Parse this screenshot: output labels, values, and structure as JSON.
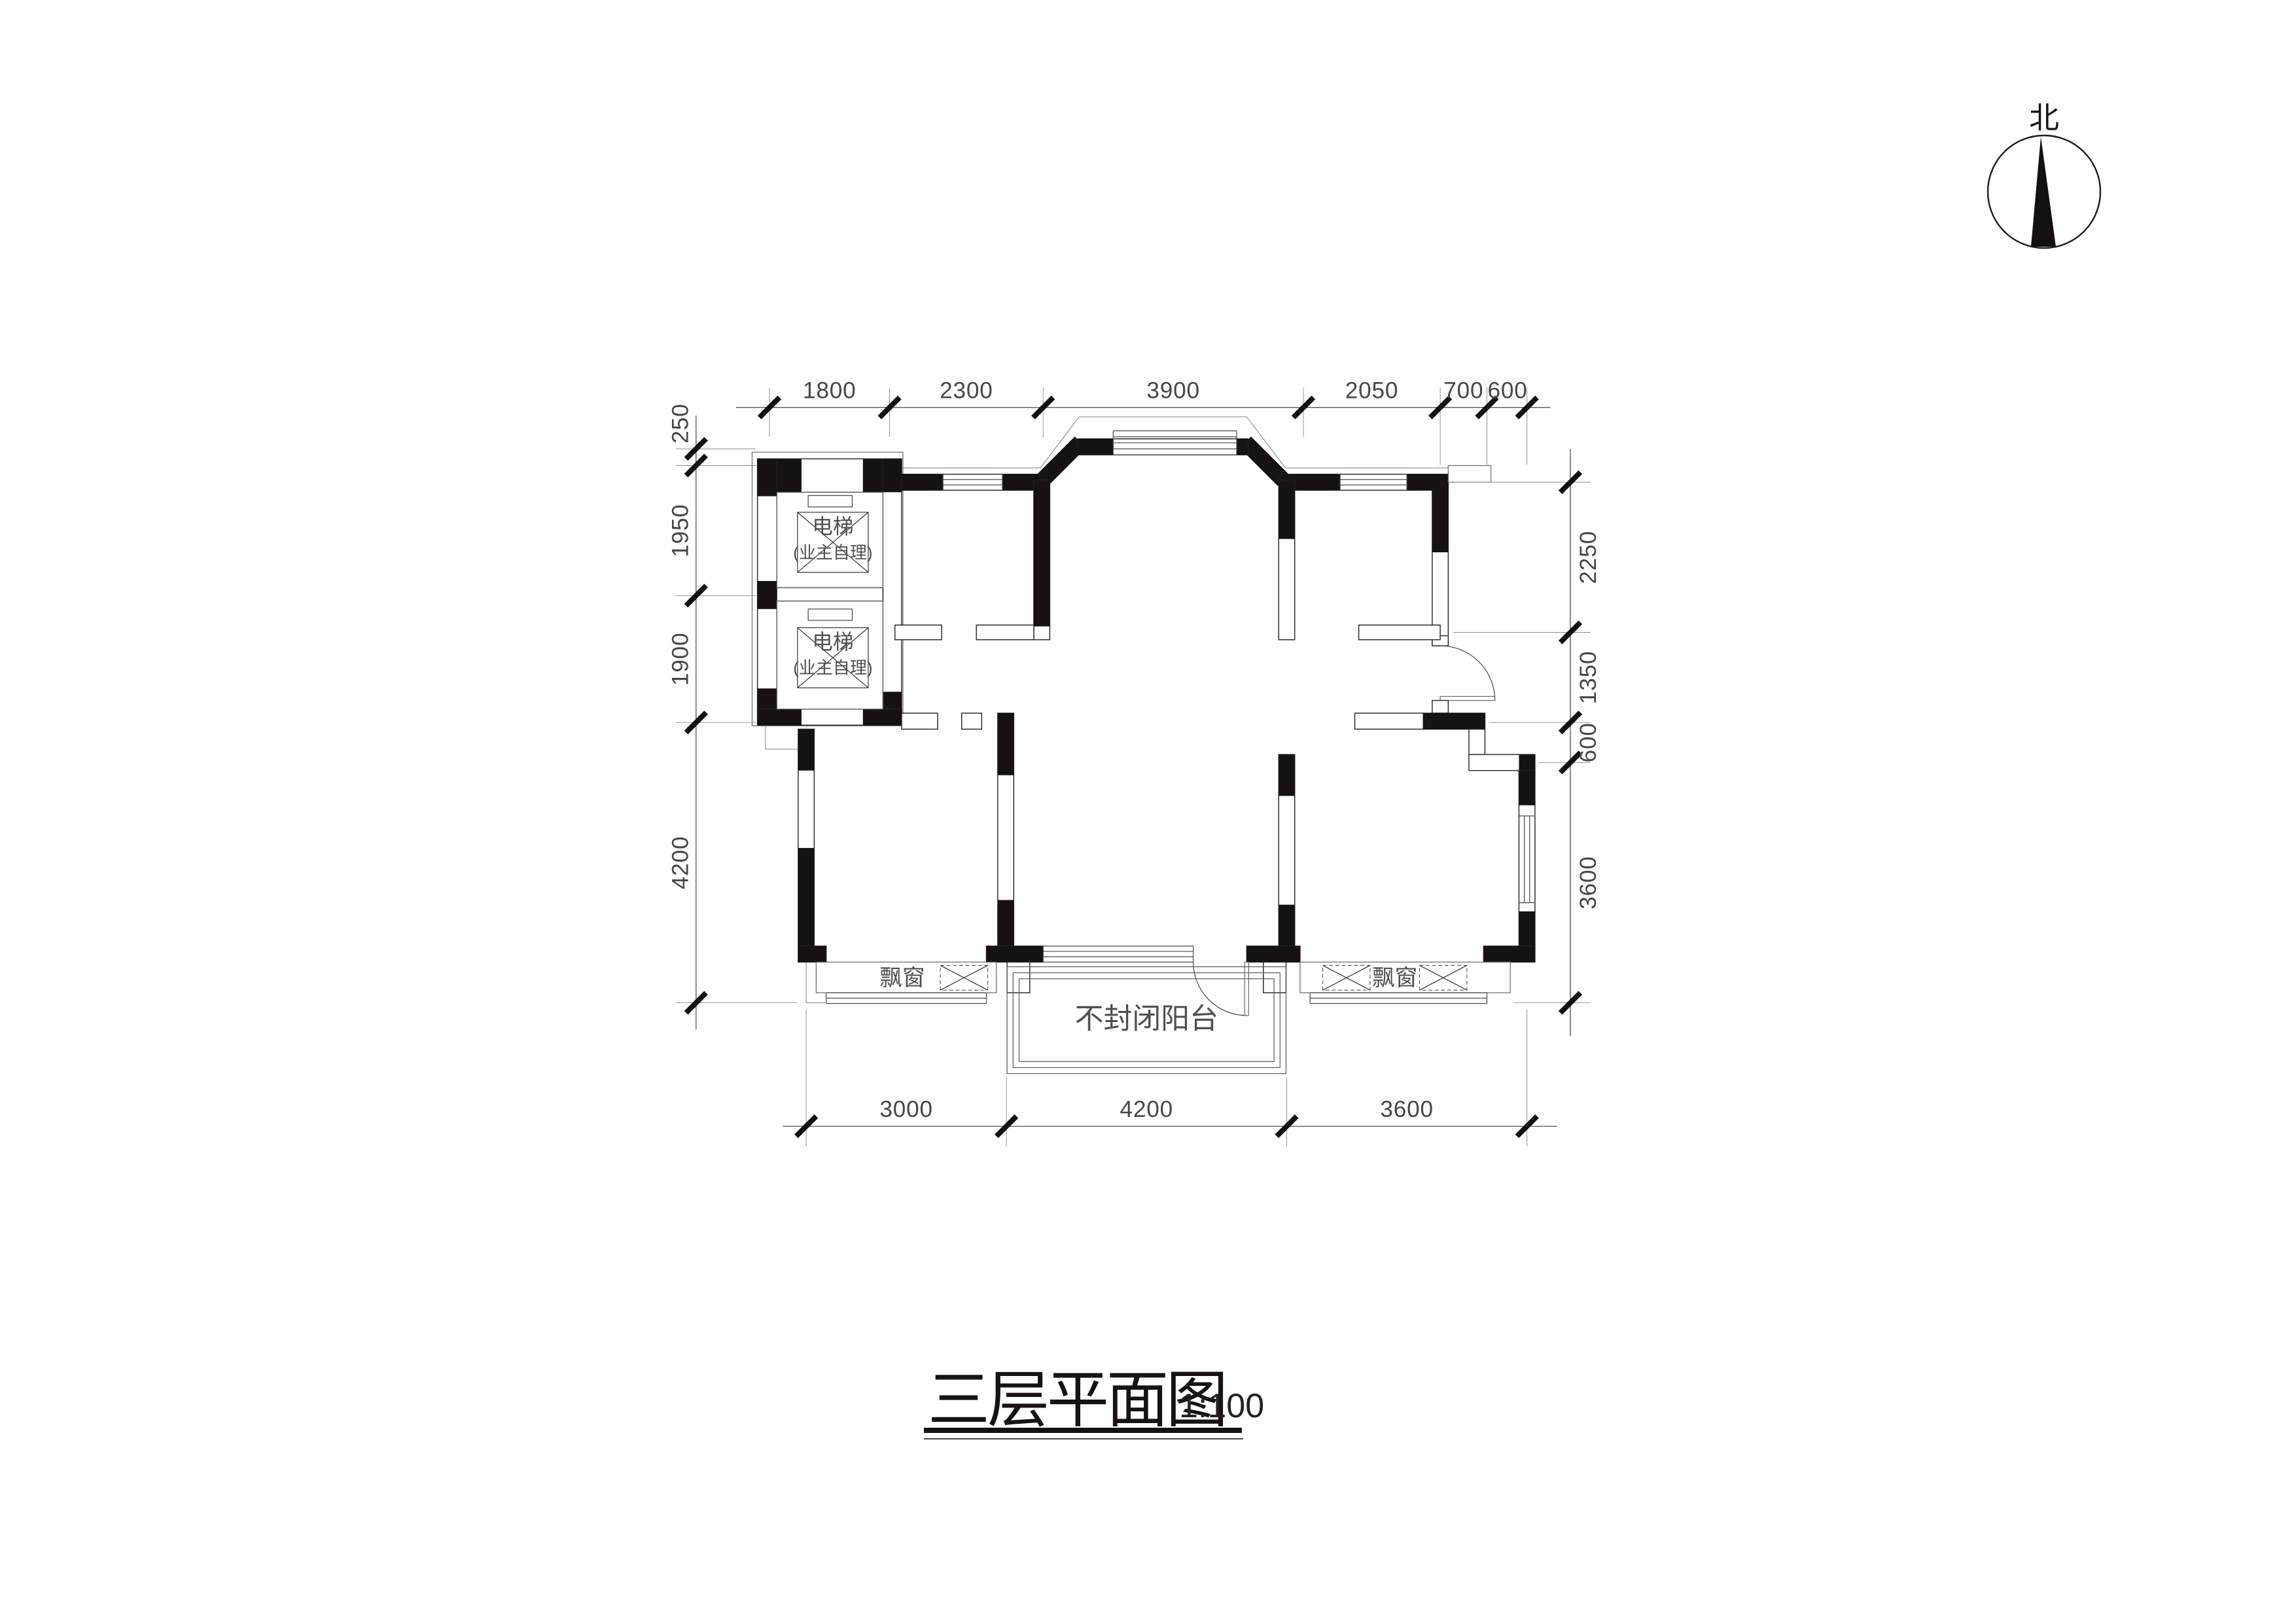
{
  "drawing": {
    "title": "三层平面图",
    "scale": "1:100",
    "type": "floor-plan"
  },
  "compass": {
    "label": "北"
  },
  "labels": {
    "elevator": "电梯",
    "elevator_note": "(业主自理)",
    "bay_window_left": "飘窗",
    "bay_window_right": "飘窗",
    "balcony": "不封闭阳台"
  },
  "dimensions": {
    "top": [
      "1800",
      "2300",
      "3900",
      "2050",
      "700",
      "600"
    ],
    "left": [
      "250",
      "1950",
      "1900",
      "4200"
    ],
    "right": [
      "2250",
      "1350",
      "600",
      "3600"
    ],
    "bottom": [
      "3000",
      "4200",
      "3600"
    ]
  },
  "colors": {
    "background": "#ffffff",
    "wall_fill": "#171111",
    "line": "#4a4545",
    "text": "#4c4444"
  }
}
